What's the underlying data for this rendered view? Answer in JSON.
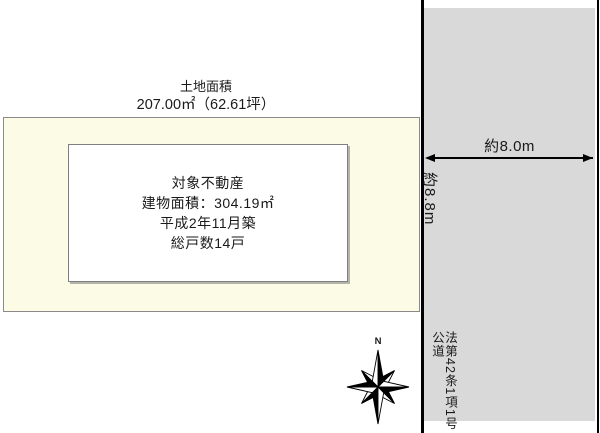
{
  "page": {
    "land": {
      "title": "土地面積",
      "area": "207.00㎡（62.61坪）"
    },
    "building": {
      "lines": [
        "対象不動産",
        "建物面積：304.19㎡",
        "平成2年11月築",
        "総戸数14戸"
      ]
    },
    "road": {
      "width": "約8.0m",
      "depth": "約8.8m",
      "law": "法第42条1項1号",
      "type": "公道"
    },
    "compass": {
      "north": "N"
    },
    "colors": {
      "plot_fill": "#fcfce6",
      "road_fill": "#d9d9d9",
      "boundary_line": "#000000",
      "box_border": "#7f7f7f"
    }
  }
}
